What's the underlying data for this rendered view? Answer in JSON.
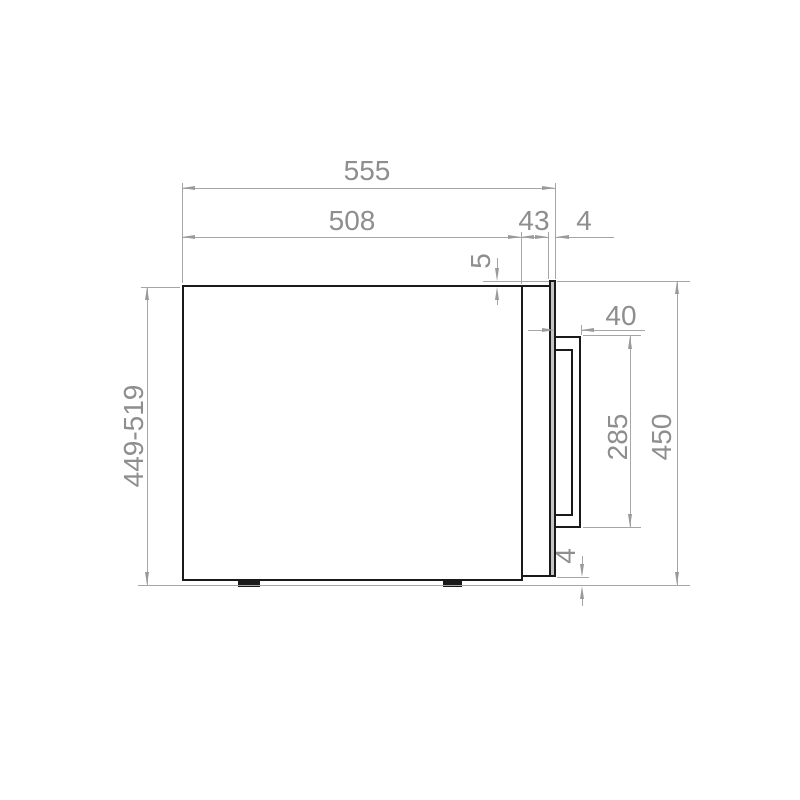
{
  "drawing": {
    "title": "appliance-side-view-dimension-drawing",
    "colors": {
      "background": "#ffffff",
      "outline": "#1a1a1a",
      "dimension_lines": "#a6a6a6",
      "dimension_text": "#8e8e8e",
      "door_fill": "#c4c4c4"
    },
    "labels": {
      "overall_width": "555",
      "body_depth": "508",
      "frame_depth": "43",
      "door_thickness": "4",
      "door_top_offset": "5",
      "handle_depth": "40",
      "handle_height": "285",
      "overall_height": "450",
      "height_range": "449-519",
      "bottom_clearance": "4"
    }
  }
}
